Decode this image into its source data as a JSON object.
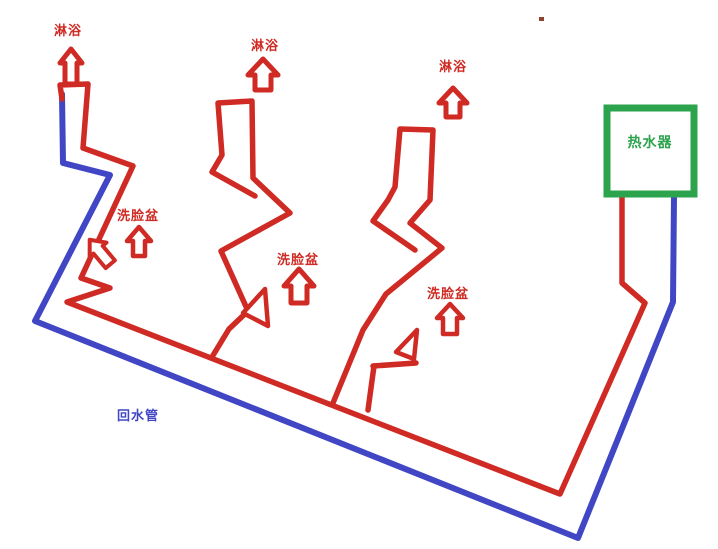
{
  "diagram": {
    "type": "hand-drawn-plumbing-schematic",
    "background_color": "#ffffff",
    "colors": {
      "hot_water_pipe": "#cf2a23",
      "return_water_pipe": "#4147c4",
      "heater_box": "#2ca34d",
      "stray_dot": "#8e4432"
    },
    "heater": {
      "label": "热水器"
    },
    "return_pipe": {
      "label": "回水管"
    },
    "showers": [
      {
        "label": "淋浴"
      },
      {
        "label": "淋浴"
      },
      {
        "label": "淋浴"
      }
    ],
    "basins": [
      {
        "label": "洗脸盆"
      },
      {
        "label": "洗脸盆"
      },
      {
        "label": "洗脸盆"
      }
    ]
  }
}
